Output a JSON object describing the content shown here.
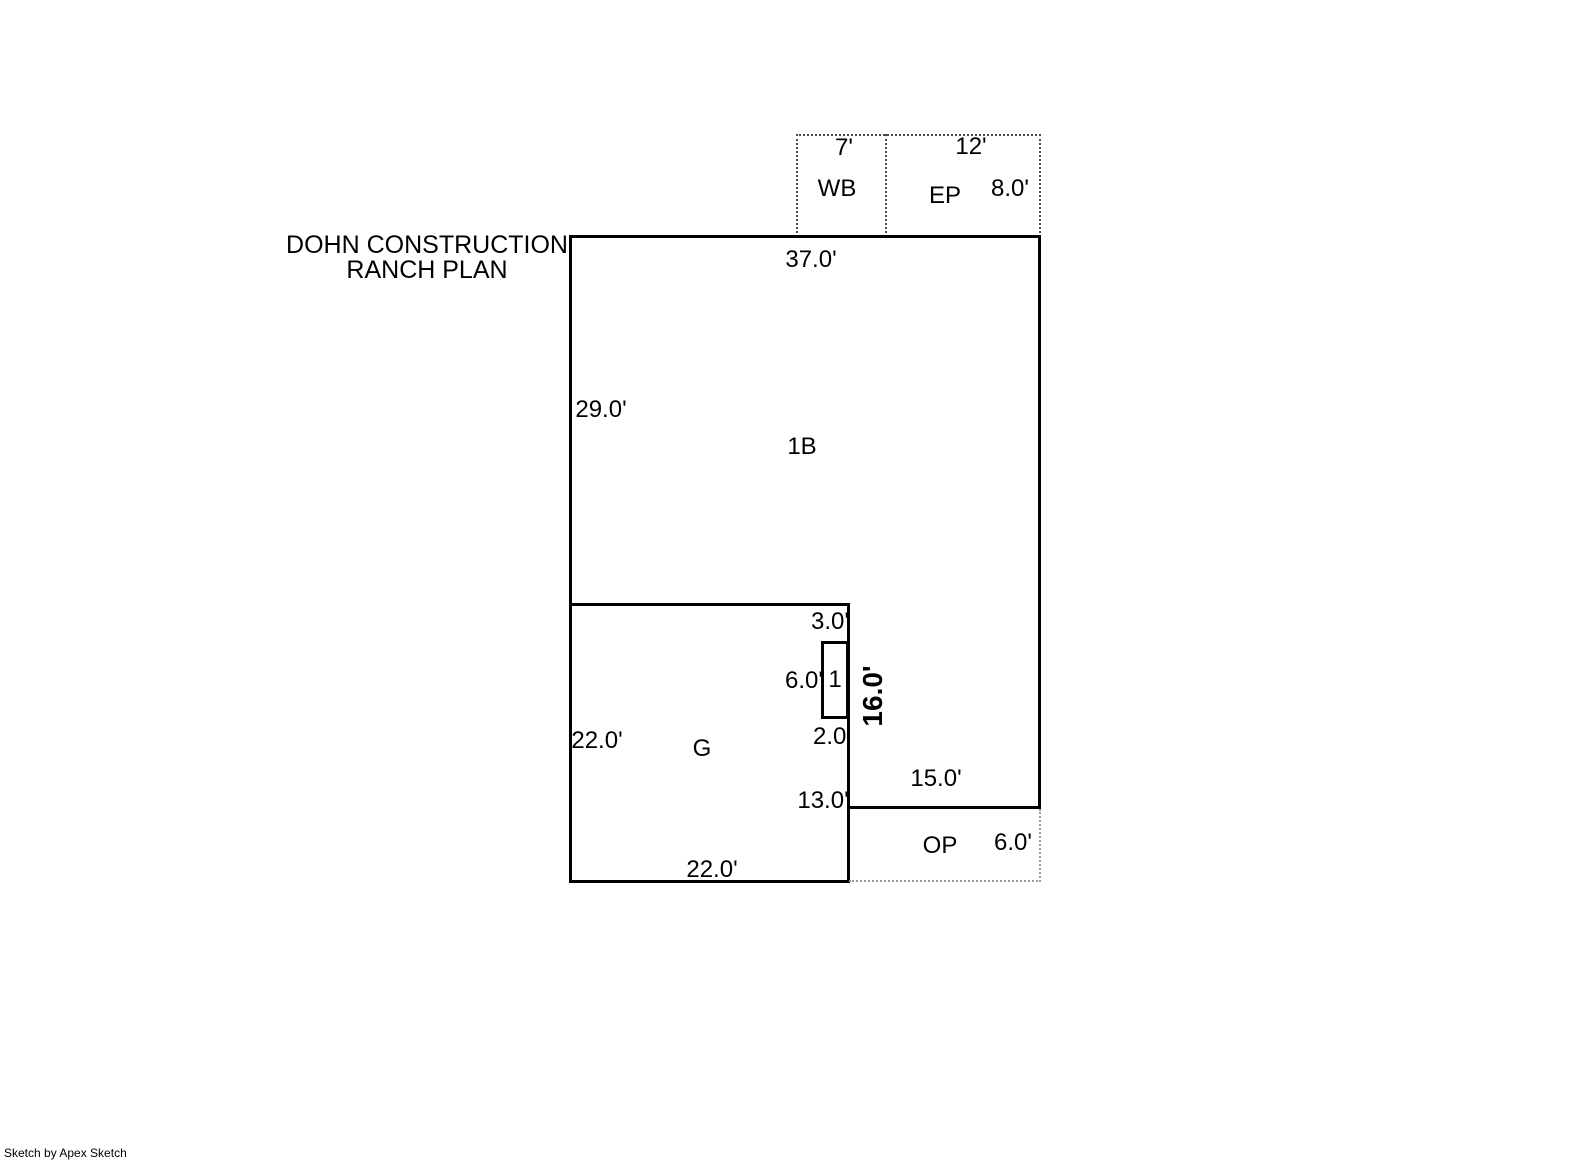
{
  "title": {
    "line1": "DOHN CONSTRUCTION",
    "line2": "RANCH PLAN"
  },
  "areas": {
    "wb": {
      "label": "WB",
      "top_dim": "7'"
    },
    "ep": {
      "label": "EP",
      "top_dim": "12'",
      "side_dim": "8.0'"
    },
    "main": {
      "label": "1B",
      "top_dim": "37.0'",
      "left_dim": "29.0'"
    },
    "garage": {
      "label": "G",
      "left_dim": "22.0'",
      "bottom_dim": "22.0'",
      "right_dim": "13.0'"
    },
    "inset": {
      "label": "1",
      "top_dim": "3.0'",
      "left_dim": "6.0'",
      "bottom_dim": "2.0'",
      "wall_dim": "16.0'"
    },
    "op": {
      "label": "OP",
      "top_dim": "15.0'",
      "side_dim": "6.0'"
    }
  },
  "credit": "Sketch by Apex Sketch",
  "colors": {
    "background": "#ffffff",
    "wall": "#000000",
    "text": "#000000",
    "attachment_dotted": "#4a4a4a",
    "porch_dotted": "#9a9a9a"
  }
}
